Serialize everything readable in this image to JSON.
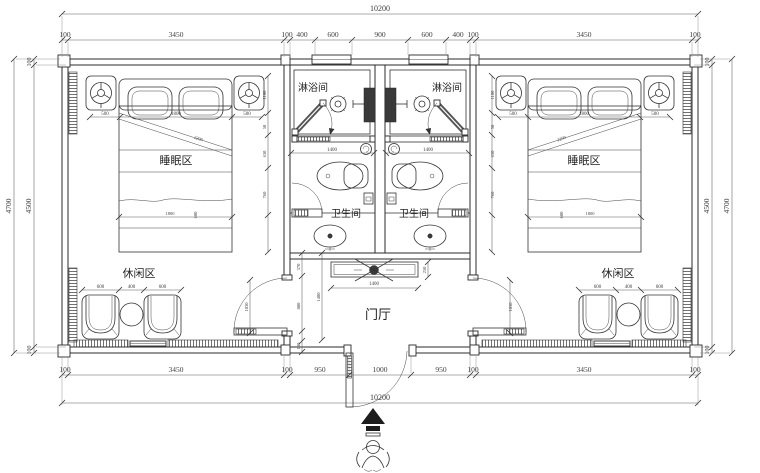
{
  "rooms": {
    "sleeping": "睡眠区",
    "shower": "淋浴间",
    "toilet": "卫生间",
    "leisure": "休闲区",
    "hall": "门厅"
  },
  "dims": {
    "overall": "10200",
    "top": [
      "100",
      "3450",
      "100",
      "400",
      "600",
      "900",
      "600",
      "400",
      "100",
      "3450",
      "100"
    ],
    "bottom": [
      "100",
      "3450",
      "100",
      "950",
      "1000",
      "950",
      "100",
      "3450",
      "100"
    ],
    "left": {
      "outer": "4700",
      "inner": "4500",
      "wall_top": "100",
      "wall_bottom": "100"
    },
    "right": {
      "outer": "4700",
      "inner": "4500",
      "wall_top": "100",
      "wall_bottom": "100"
    },
    "bed": [
      "500",
      "1800",
      "500"
    ],
    "bed_side": [
      "1100",
      "50",
      "630",
      "760"
    ],
    "bed_diag": "2200",
    "bed_foot": {
      "w": "1800",
      "h": "600"
    },
    "chairs": [
      "600",
      "400",
      "600"
    ],
    "bath_width": "1400",
    "hall_v": [
      "370",
      "880",
      "180"
    ],
    "hall_h": "1400",
    "console": {
      "w": "1400",
      "d": "250"
    },
    "room_door": "1030"
  }
}
